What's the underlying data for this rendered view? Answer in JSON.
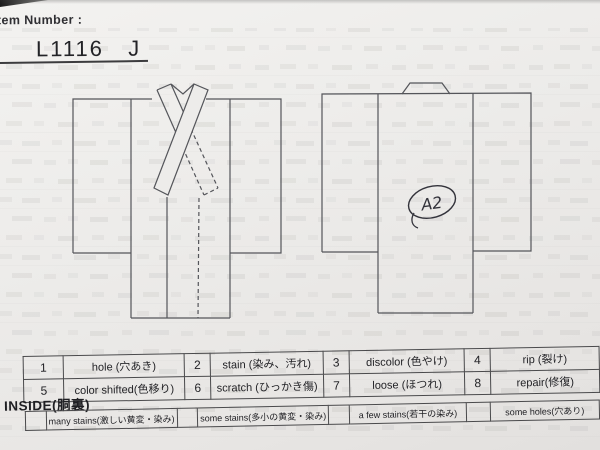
{
  "colors": {
    "paper": "#edecea",
    "diagram_line": "#54555a",
    "table_border": "#4a4a4c",
    "handwriting_ink": "#33333b",
    "text": "#2b2b2e"
  },
  "header": {
    "label": "Item Number :",
    "item_number": "L1116   J"
  },
  "diagrams": {
    "front": "kimono-front-view",
    "back": "kimono-back-view",
    "annotation": "A2"
  },
  "condition_codes": {
    "rows": [
      {
        "cells": [
          {
            "num": "1",
            "label": "hole (穴あき)"
          },
          {
            "num": "2",
            "label": "stain (染み、汚れ)"
          },
          {
            "num": "3",
            "label": "discolor (色やけ)"
          },
          {
            "num": "4",
            "label": "rip (裂け)"
          }
        ]
      },
      {
        "cells": [
          {
            "num": "5",
            "label": "color shifted(色移り)"
          },
          {
            "num": "6",
            "label": "scratch (ひっかき傷)"
          },
          {
            "num": "7",
            "label": "loose (ほつれ)"
          },
          {
            "num": "8",
            "label": "repair(修復)"
          }
        ]
      }
    ]
  },
  "inside": {
    "heading": "INSIDE(胴裏)",
    "options": [
      "many stains(激しい黄変・染み)",
      "some stains(多小の黄変・染み)",
      "a few stains(若干の染み)",
      "some holes(穴あり)"
    ]
  }
}
